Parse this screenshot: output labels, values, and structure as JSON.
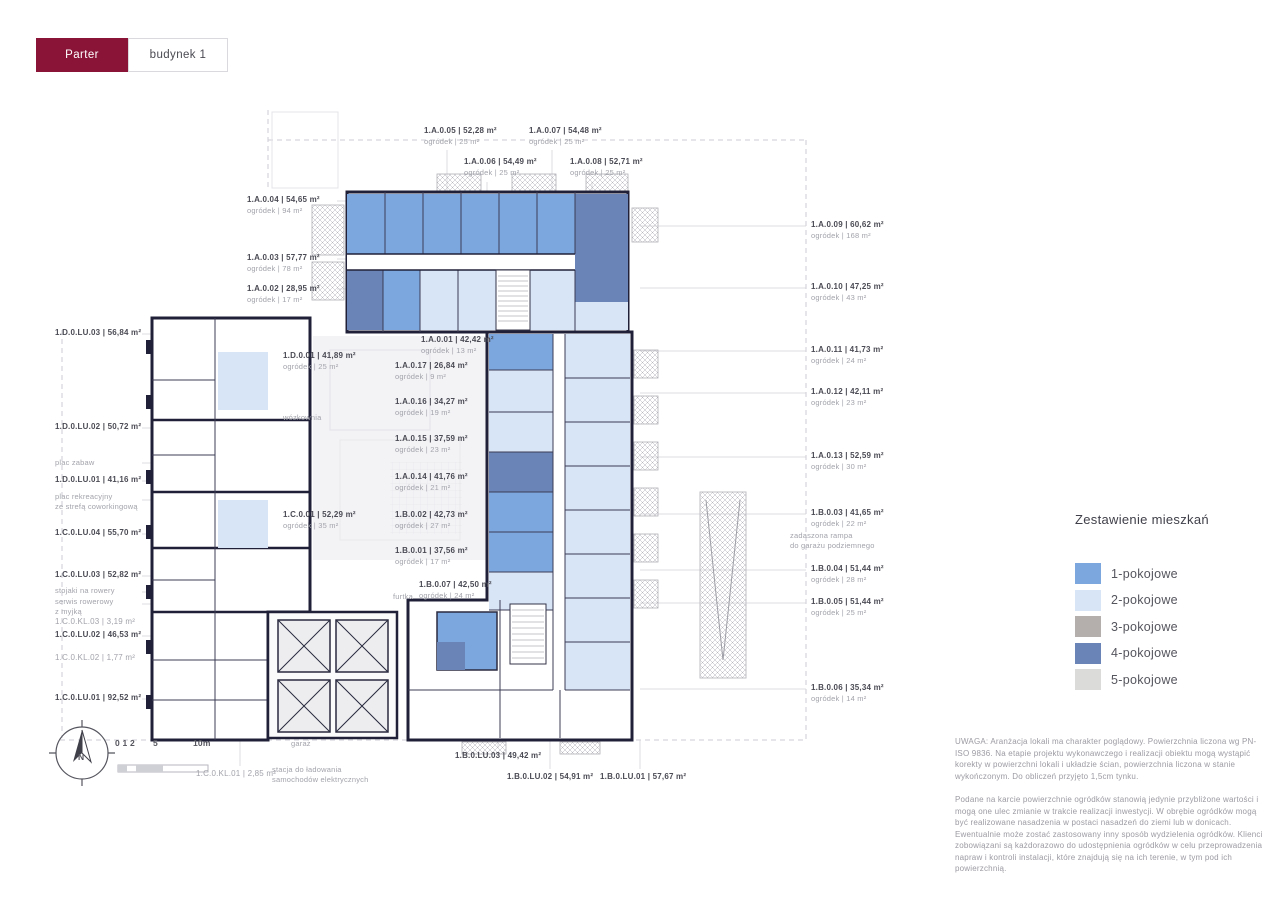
{
  "app": {
    "tabs": [
      {
        "label": "Parter",
        "active": true
      },
      {
        "label": "budynek 1",
        "active": false
      }
    ]
  },
  "legend": {
    "title": "Zestawienie mieszkań",
    "items": [
      {
        "label": "1-pokojowe",
        "color": "#7ba7de"
      },
      {
        "label": "2-pokojowe",
        "color": "#d8e5f6"
      },
      {
        "label": "3-pokojowe",
        "color": "#b4afac"
      },
      {
        "label": "4-pokojowe",
        "color": "#6a84b8"
      },
      {
        "label": "5-pokojowe",
        "color": "#dbdbd9"
      }
    ]
  },
  "plan": {
    "garden_word": "ogródek",
    "unit_labels": [
      {
        "id": "1.A.0.05",
        "area": "52,28 m²",
        "garden": "25 m²",
        "x": 424,
        "y": 125
      },
      {
        "id": "1.A.0.07",
        "area": "54,48 m²",
        "garden": "25 m²",
        "x": 529,
        "y": 125
      },
      {
        "id": "1.A.0.06",
        "area": "54,49 m²",
        "garden": "25 m²",
        "x": 464,
        "y": 156
      },
      {
        "id": "1.A.0.08",
        "area": "52,71 m²",
        "garden": "25 m²",
        "x": 570,
        "y": 156
      },
      {
        "id": "1.A.0.04",
        "area": "54,65 m²",
        "garden": "94 m²",
        "x": 247,
        "y": 194
      },
      {
        "id": "1.A.0.03",
        "area": "57,77 m²",
        "garden": "78 m²",
        "x": 247,
        "y": 252
      },
      {
        "id": "1.A.0.02",
        "area": "28,95 m²",
        "garden": "17 m²",
        "x": 247,
        "y": 283
      },
      {
        "id": "1.A.0.09",
        "area": "60,62 m²",
        "garden": "168 m²",
        "x": 811,
        "y": 219
      },
      {
        "id": "1.A.0.10",
        "area": "47,25 m²",
        "garden": "43 m²",
        "x": 811,
        "y": 281
      },
      {
        "id": "1.A.0.11",
        "area": "41,73 m²",
        "garden": "24 m²",
        "x": 811,
        "y": 344
      },
      {
        "id": "1.A.0.12",
        "area": "42,11 m²",
        "garden": "23 m²",
        "x": 811,
        "y": 386
      },
      {
        "id": "1.A.0.13",
        "area": "52,59 m²",
        "garden": "30 m²",
        "x": 811,
        "y": 450
      },
      {
        "id": "1.B.0.03",
        "area": "41,65 m²",
        "garden": "22 m²",
        "x": 811,
        "y": 507
      },
      {
        "id": "1.B.0.04",
        "area": "51,44 m²",
        "garden": "28 m²",
        "x": 811,
        "y": 563
      },
      {
        "id": "1.B.0.05",
        "area": "51,44 m²",
        "garden": "25 m²",
        "x": 811,
        "y": 596
      },
      {
        "id": "1.B.0.06",
        "area": "35,34 m²",
        "garden": "14 m²",
        "x": 811,
        "y": 682
      },
      {
        "id": "1.D.0.LU.03",
        "area": "56,84 m²",
        "x": 55,
        "y": 327
      },
      {
        "id": "1.D.0.LU.02",
        "area": "50,72 m²",
        "x": 55,
        "y": 421
      },
      {
        "id": "1.D.0.LU.01",
        "area": "41,16 m²",
        "x": 55,
        "y": 474
      },
      {
        "id": "1.C.0.LU.04",
        "area": "55,70 m²",
        "x": 55,
        "y": 527
      },
      {
        "id": "1.C.0.LU.03",
        "area": "52,82 m²",
        "x": 55,
        "y": 569
      },
      {
        "id": "1.C.0.KL.03",
        "area": "3,19 m²",
        "x": 55,
        "y": 616,
        "muted": true
      },
      {
        "id": "1.C.0.LU.02",
        "area": "46,53 m²",
        "x": 55,
        "y": 629
      },
      {
        "id": "1.C.0.KL.02",
        "area": "1,77 m²",
        "x": 55,
        "y": 652,
        "muted": true
      },
      {
        "id": "1.C.0.LU.01",
        "area": "92,52 m²",
        "x": 55,
        "y": 692
      },
      {
        "id": "1.A.0.01",
        "area": "42,42 m²",
        "garden": "13 m²",
        "x": 421,
        "y": 334
      },
      {
        "id": "1.D.0.01",
        "area": "41,89 m²",
        "garden": "25 m²",
        "x": 283,
        "y": 350
      },
      {
        "id": "1.A.0.17",
        "area": "26,84 m²",
        "garden": "9 m²",
        "x": 395,
        "y": 360
      },
      {
        "id": "1.A.0.16",
        "area": "34,27 m²",
        "garden": "19 m²",
        "x": 395,
        "y": 396
      },
      {
        "id": "1.A.0.15",
        "area": "37,59 m²",
        "garden": "23 m²",
        "x": 395,
        "y": 433
      },
      {
        "id": "1.A.0.14",
        "area": "41,76 m²",
        "garden": "21 m²",
        "x": 395,
        "y": 471
      },
      {
        "id": "1.C.0.01",
        "area": "52,29 m²",
        "garden": "35 m²",
        "x": 283,
        "y": 509
      },
      {
        "id": "1.B.0.02",
        "area": "42,73 m²",
        "garden": "27 m²",
        "x": 395,
        "y": 509
      },
      {
        "id": "1.B.0.01",
        "area": "37,56 m²",
        "garden": "17 m²",
        "x": 395,
        "y": 545
      },
      {
        "id": "1.B.0.07",
        "area": "42,50 m²",
        "garden": "24 m²",
        "x": 419,
        "y": 579
      },
      {
        "id": "1.B.0.LU.03",
        "area": "49,42 m²",
        "x": 455,
        "y": 750
      },
      {
        "id": "1.C.0.KL.01",
        "area": "2,85 m²",
        "x": 196,
        "y": 768,
        "muted": true
      },
      {
        "id": "1.B.0.LU.02",
        "area": "54,91 m²",
        "x": 507,
        "y": 771
      },
      {
        "id": "1.B.0.LU.01",
        "area": "57,67 m²",
        "x": 600,
        "y": 771
      }
    ],
    "text_labels": [
      {
        "text": "plac zabaw",
        "x": 55,
        "y": 458
      },
      {
        "text": "plac rekreacyjny\nze strefą coworkingową",
        "x": 55,
        "y": 492
      },
      {
        "text": "stojaki na rowery",
        "x": 55,
        "y": 586
      },
      {
        "text": "serwis rowerowy\nz myjką",
        "x": 55,
        "y": 597
      },
      {
        "text": "zadaszona rampa\ndo garażu podziemnego",
        "x": 790,
        "y": 531
      },
      {
        "text": "wózkownia",
        "x": 283,
        "y": 413
      },
      {
        "text": "furtka",
        "x": 393,
        "y": 592
      },
      {
        "text": "garaż",
        "x": 291,
        "y": 739
      },
      {
        "text": "stacja do ładowania\nsamochodów elektrycznych",
        "x": 272,
        "y": 765
      },
      {
        "text": "0 1 2",
        "x": 115,
        "y": 738,
        "dark": true
      },
      {
        "text": "5",
        "x": 153,
        "y": 738,
        "dark": true
      },
      {
        "text": "10m",
        "x": 193,
        "y": 738,
        "dark": true
      },
      {
        "text": "N",
        "x": 78,
        "y": 752,
        "dark": true
      }
    ]
  },
  "notes": [
    "UWAGA: Aranżacja lokali ma charakter poglądowy. Powierzchnia liczona wg PN-ISO 9836. Na etapie projektu wykonawczego i realizacji obiektu mogą wystąpić korekty w powierzchni lokali i układzie ścian, powierzchnia liczona w stanie wykończonym. Do obliczeń przyjęto 1,5cm tynku.",
    "Podane na karcie powierzchnie ogródków stanowią jedynie przybliżone wartości i mogą one ulec zmianie w trakcie realizacji inwestycji. W obrębie ogródków mogą być realizowane nasadzenia w postaci nasadzeń do ziemi lub w donicach. Ewentualnie może zostać zastosowany inny sposób wydzielenia ogródków. Klienci zobowiązani są każdorazowo do udostępnienia ogródków w celu przeprowadzenia napraw i kontroli instalacji, które znajdują się na ich terenie, w tym pod ich powierzchnią."
  ],
  "colors": {
    "accent": "#8a1437",
    "wall": "#202138"
  }
}
